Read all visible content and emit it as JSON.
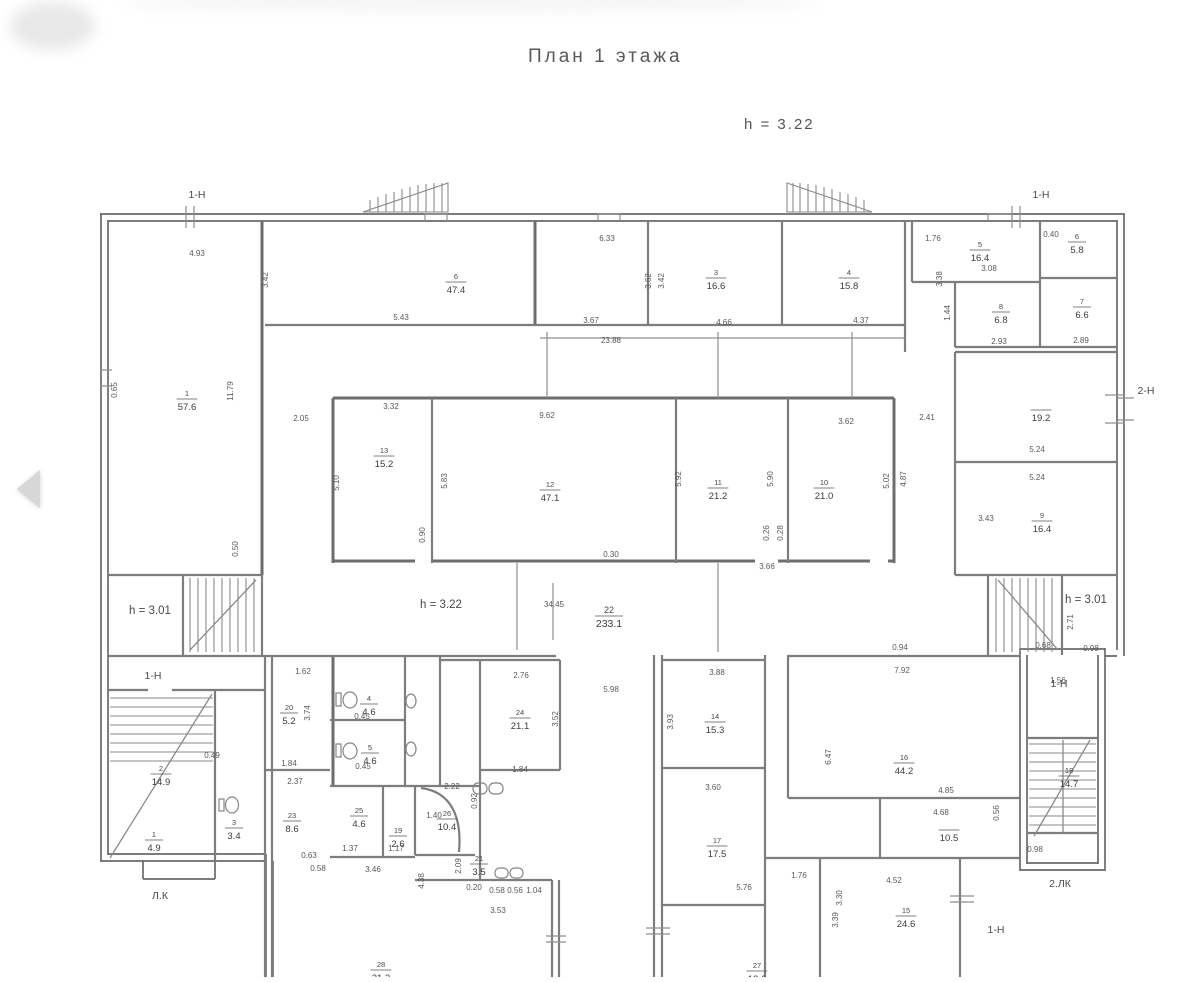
{
  "viewer": {
    "prev_arrow_icon": "left-triangle"
  },
  "drawing": {
    "title": "План 1 этажа",
    "floor_height_note": "h = 3.22",
    "height_notes": [
      {
        "t": "h = 3.01",
        "x": 150,
        "y": 614
      },
      {
        "t": "h = 3.22",
        "x": 441,
        "y": 608
      },
      {
        "t": "h = 3.01",
        "x": 1086,
        "y": 603
      }
    ],
    "markers": [
      {
        "t": "1-Н",
        "x": 197,
        "y": 198
      },
      {
        "t": "1-Н",
        "x": 1041,
        "y": 198
      },
      {
        "t": "2-Н",
        "x": 1146,
        "y": 394
      },
      {
        "t": "1-Н",
        "x": 153,
        "y": 679
      },
      {
        "t": "1-Н",
        "x": 1059,
        "y": 687
      },
      {
        "t": "1-Н",
        "x": 996,
        "y": 933
      },
      {
        "t": "Л.К",
        "x": 160,
        "y": 899
      },
      {
        "t": "2.ЛК",
        "x": 1060,
        "y": 887
      }
    ],
    "rooms": [
      {
        "n": "1",
        "a": "57.6",
        "x": 187,
        "y": 399
      },
      {
        "n": "6",
        "a": "47.4",
        "x": 456,
        "y": 282
      },
      {
        "n": "3",
        "a": "16.6",
        "x": 716,
        "y": 278
      },
      {
        "n": "4",
        "a": "15.8",
        "x": 849,
        "y": 278
      },
      {
        "n": "5",
        "a": "16.4",
        "x": 980,
        "y": 250
      },
      {
        "n": "6",
        "a": "5.8",
        "x": 1077,
        "y": 242
      },
      {
        "n": "8",
        "a": "6.8",
        "x": 1001,
        "y": 312
      },
      {
        "n": "7",
        "a": "6.6",
        "x": 1082,
        "y": 307
      },
      {
        "n": "",
        "a": "19.2",
        "x": 1041,
        "y": 410
      },
      {
        "n": "9",
        "a": "16.4",
        "x": 1042,
        "y": 521
      },
      {
        "n": "13",
        "a": "15.2",
        "x": 384,
        "y": 456
      },
      {
        "n": "12",
        "a": "47.1",
        "x": 550,
        "y": 490
      },
      {
        "n": "11",
        "a": "21.2",
        "x": 718,
        "y": 488
      },
      {
        "n": "10",
        "a": "21.0",
        "x": 824,
        "y": 488
      },
      {
        "n": "22",
        "a": "233.1",
        "x": 609,
        "y": 616
      },
      {
        "n": "2",
        "a": "14.9",
        "x": 161,
        "y": 774
      },
      {
        "n": "1",
        "a": "4.9",
        "x": 154,
        "y": 840
      },
      {
        "n": "3",
        "a": "3.4",
        "x": 234,
        "y": 828
      },
      {
        "n": "20",
        "a": "5.2",
        "x": 289,
        "y": 713
      },
      {
        "n": "23",
        "a": "8.6",
        "x": 292,
        "y": 821
      },
      {
        "n": "4",
        "a": "4.6",
        "x": 369,
        "y": 704
      },
      {
        "n": "5",
        "a": "4.6",
        "x": 370,
        "y": 753
      },
      {
        "n": "24",
        "a": "21.1",
        "x": 520,
        "y": 718
      },
      {
        "n": "25",
        "a": "4.6",
        "x": 359,
        "y": 816
      },
      {
        "n": "19",
        "a": "2.6",
        "x": 398,
        "y": 836
      },
      {
        "n": "26",
        "a": "10.4",
        "x": 447,
        "y": 819
      },
      {
        "n": "21",
        "a": "3.5",
        "x": 479,
        "y": 864
      },
      {
        "n": "14",
        "a": "15.3",
        "x": 715,
        "y": 722
      },
      {
        "n": "17",
        "a": "17.5",
        "x": 717,
        "y": 846
      },
      {
        "n": "16",
        "a": "44.2",
        "x": 904,
        "y": 763
      },
      {
        "n": "",
        "a": "10.5",
        "x": 949,
        "y": 830
      },
      {
        "n": "15",
        "a": "24.6",
        "x": 906,
        "y": 916
      },
      {
        "n": "18",
        "a": "14.7",
        "x": 1069,
        "y": 776
      },
      {
        "n": "28",
        "a": "21.3",
        "x": 381,
        "y": 970
      },
      {
        "n": "27",
        "a": "12.6",
        "x": 757,
        "y": 971
      }
    ],
    "dimensions": [
      [
        "4.93",
        197,
        256,
        0
      ],
      [
        "3.42",
        268,
        280,
        1
      ],
      [
        "6.33",
        607,
        241,
        0
      ],
      [
        "5.43",
        401,
        320,
        0
      ],
      [
        "3.67",
        591,
        323,
        0
      ],
      [
        "23.88",
        611,
        343,
        0
      ],
      [
        "4.66",
        724,
        325,
        0
      ],
      [
        "4.37",
        861,
        323,
        0
      ],
      [
        "3.62",
        651,
        281,
        1
      ],
      [
        "3.42",
        664,
        281,
        1
      ],
      [
        "1.76",
        933,
        241,
        0
      ],
      [
        "3.38",
        942,
        279,
        1
      ],
      [
        "3.08",
        989,
        271,
        0
      ],
      [
        "1.44",
        950,
        313,
        1
      ],
      [
        "2.93",
        999,
        344,
        0
      ],
      [
        "2.89",
        1081,
        343,
        0
      ],
      [
        "0.40",
        1051,
        237,
        0
      ],
      [
        "2.41",
        927,
        420,
        0
      ],
      [
        "4.87",
        906,
        479,
        1
      ],
      [
        "5.24",
        1037,
        452,
        0
      ],
      [
        "5.24",
        1037,
        480,
        0
      ],
      [
        "3.43",
        986,
        521,
        0
      ],
      [
        "0.65",
        117,
        390,
        1
      ],
      [
        "11.79",
        233,
        391,
        1
      ],
      [
        "0.50",
        238,
        549,
        1
      ],
      [
        "2.05",
        301,
        421,
        0
      ],
      [
        "3.32",
        391,
        409,
        0
      ],
      [
        "9.62",
        547,
        418,
        0
      ],
      [
        "3.62",
        846,
        424,
        0
      ],
      [
        "5.10",
        339,
        483,
        1
      ],
      [
        "5.83",
        447,
        481,
        1
      ],
      [
        "5.92",
        681,
        479,
        1
      ],
      [
        "5.90",
        773,
        479,
        1
      ],
      [
        "5.02",
        889,
        481,
        1
      ],
      [
        "0.90",
        425,
        535,
        1
      ],
      [
        "0.26",
        769,
        533,
        1
      ],
      [
        "0.28",
        783,
        533,
        1
      ],
      [
        "0.30",
        611,
        557,
        0
      ],
      [
        "3.66",
        767,
        569,
        0
      ],
      [
        "34.45",
        554,
        607,
        0
      ],
      [
        "5.98",
        611,
        692,
        0
      ],
      [
        "2.71",
        1073,
        622,
        1
      ],
      [
        "0.98",
        1091,
        651,
        0
      ],
      [
        "1.62",
        303,
        674,
        0
      ],
      [
        "0.49",
        212,
        758,
        0
      ],
      [
        "1.84",
        289,
        766,
        0
      ],
      [
        "2.37",
        295,
        784,
        0
      ],
      [
        "3.74",
        310,
        713,
        1
      ],
      [
        "0.45",
        362,
        719,
        0
      ],
      [
        "0.45",
        363,
        769,
        0
      ],
      [
        "1.37",
        350,
        851,
        0
      ],
      [
        "1.17",
        396,
        851,
        0
      ],
      [
        "3.46",
        373,
        872,
        0
      ],
      [
        "0.63",
        309,
        858,
        0
      ],
      [
        "0.58",
        318,
        871,
        0
      ],
      [
        "2.22",
        452,
        789,
        0
      ],
      [
        "0.92",
        477,
        801,
        1
      ],
      [
        "1.40",
        434,
        818,
        0
      ],
      [
        "2.09",
        461,
        866,
        1
      ],
      [
        "4.38",
        424,
        881,
        1
      ],
      [
        "0.20",
        474,
        890,
        0
      ],
      [
        "0.58",
        497,
        893,
        0
      ],
      [
        "0.56",
        515,
        893,
        0
      ],
      [
        "1.04",
        534,
        893,
        0
      ],
      [
        "3.53",
        498,
        913,
        0
      ],
      [
        "2.76",
        521,
        678,
        0
      ],
      [
        "3.52",
        558,
        719,
        1
      ],
      [
        "1.84",
        520,
        772,
        0
      ],
      [
        "3.88",
        717,
        675,
        0
      ],
      [
        "3.93",
        673,
        722,
        1
      ],
      [
        "3.60",
        713,
        790,
        0
      ],
      [
        "6.47",
        831,
        757,
        1
      ],
      [
        "1.76",
        799,
        878,
        0
      ],
      [
        "5.76",
        744,
        890,
        0
      ],
      [
        "3.30",
        842,
        898,
        1
      ],
      [
        "7.92",
        902,
        673,
        0
      ],
      [
        "4.85",
        946,
        793,
        0
      ],
      [
        "4.68",
        941,
        815,
        0
      ],
      [
        "0.56",
        999,
        813,
        1
      ],
      [
        "4.52",
        894,
        883,
        0
      ],
      [
        "3.39",
        838,
        920,
        1
      ],
      [
        "1.56",
        1058,
        683,
        0
      ],
      [
        "0.68",
        1043,
        648,
        0
      ],
      [
        "0.94",
        900,
        650,
        0
      ],
      [
        "0.98",
        1035,
        852,
        0
      ]
    ]
  }
}
